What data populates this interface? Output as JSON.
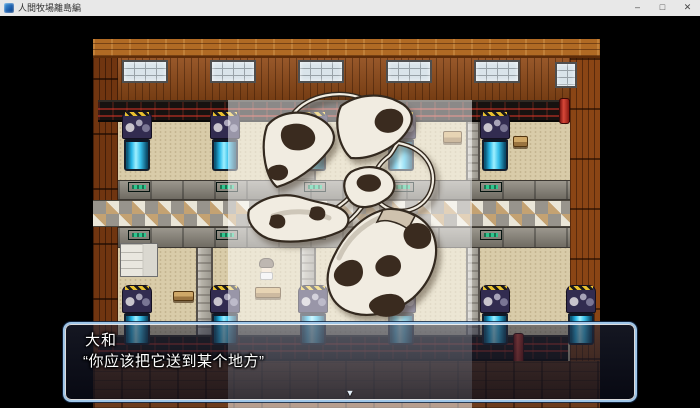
{
  "window": {
    "title": "人間牧場離島編",
    "controls": {
      "minimize": "–",
      "maximize": "□",
      "close": "✕"
    }
  },
  "game": {
    "dialog": {
      "speaker": "大和",
      "line": "“你应该把它送到某个地方”",
      "continue_indicator": "▼"
    },
    "picture": {
      "subject": "cow-print bikini set"
    },
    "colors": {
      "title_bar": "#e8e8e8",
      "dialog_border": "#9fc6e8",
      "tank_cyan": "#45d0f5",
      "panel_green": "#2ec68e",
      "conveyor_red": "#7d241c",
      "sand_floor": "#d9cca9",
      "wall_wood": "#8f4a18"
    }
  },
  "icons": {
    "app_icon": "rpg-game-icon",
    "minimize": "minimize-icon",
    "maximize": "maximize-icon",
    "close": "close-icon",
    "continue_indicator": "down-arrow-icon"
  }
}
